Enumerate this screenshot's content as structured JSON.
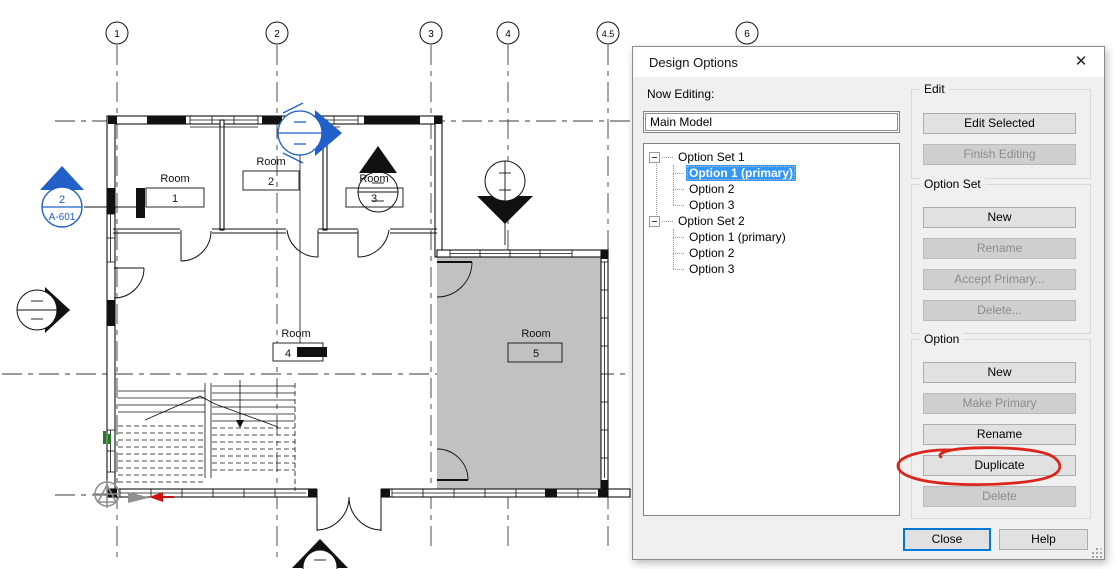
{
  "plan": {
    "grid_bubbles": [
      {
        "label": "1"
      },
      {
        "label": "2"
      },
      {
        "label": "3"
      },
      {
        "label": "4"
      },
      {
        "label": "4.5"
      },
      {
        "label": "6"
      }
    ],
    "rooms": [
      {
        "name": "Room",
        "number": "1"
      },
      {
        "name": "Room",
        "number": "2"
      },
      {
        "name": "Room",
        "number": "3"
      },
      {
        "name": "Room",
        "number": "4"
      },
      {
        "name": "Room",
        "number": "5"
      }
    ],
    "section_marker": {
      "detail_number": "2",
      "sheet_number": "A-601"
    }
  },
  "dialog": {
    "title": "Design Options",
    "close_glyph": "✕",
    "now_editing_label": "Now Editing:",
    "now_editing_value": "Main Model",
    "tree": {
      "items": [
        {
          "label": "Option Set 1",
          "type": "set"
        },
        {
          "label": "Option 1 (primary)",
          "type": "option",
          "selected": true
        },
        {
          "label": "Option 2",
          "type": "option"
        },
        {
          "label": "Option 3",
          "type": "option"
        },
        {
          "label": "Option Set 2",
          "type": "set"
        },
        {
          "label": "Option 1 (primary)",
          "type": "option"
        },
        {
          "label": "Option 2",
          "type": "option"
        },
        {
          "label": "Option 3",
          "type": "option"
        }
      ]
    },
    "groups": {
      "edit": {
        "label": "Edit",
        "buttons": [
          {
            "label": "Edit Selected",
            "enabled": true
          },
          {
            "label": "Finish Editing",
            "enabled": false
          }
        ]
      },
      "option_set": {
        "label": "Option Set",
        "buttons": [
          {
            "label": "New",
            "enabled": true
          },
          {
            "label": "Rename",
            "enabled": false
          },
          {
            "label": "Accept Primary...",
            "enabled": false
          },
          {
            "label": "Delete...",
            "enabled": false
          }
        ]
      },
      "option": {
        "label": "Option",
        "buttons": [
          {
            "label": "New",
            "enabled": true
          },
          {
            "label": "Make Primary",
            "enabled": false
          },
          {
            "label": "Rename",
            "enabled": true
          },
          {
            "label": "Duplicate",
            "enabled": true,
            "annotated": "red-circle"
          },
          {
            "label": "Delete",
            "enabled": false
          }
        ]
      }
    },
    "footer": {
      "close_label": "Close",
      "help_label": "Help"
    }
  },
  "annotation": {
    "shape": "freehand-ellipse",
    "target": "Duplicate",
    "color": "#da251d"
  },
  "colors": {
    "selection_blue": "#3296ff",
    "default_button_border": "#0078d7",
    "annotation_red": "#da251d",
    "marker_blue": "#2060c8",
    "option_area_gray": "#c1c1c1"
  }
}
